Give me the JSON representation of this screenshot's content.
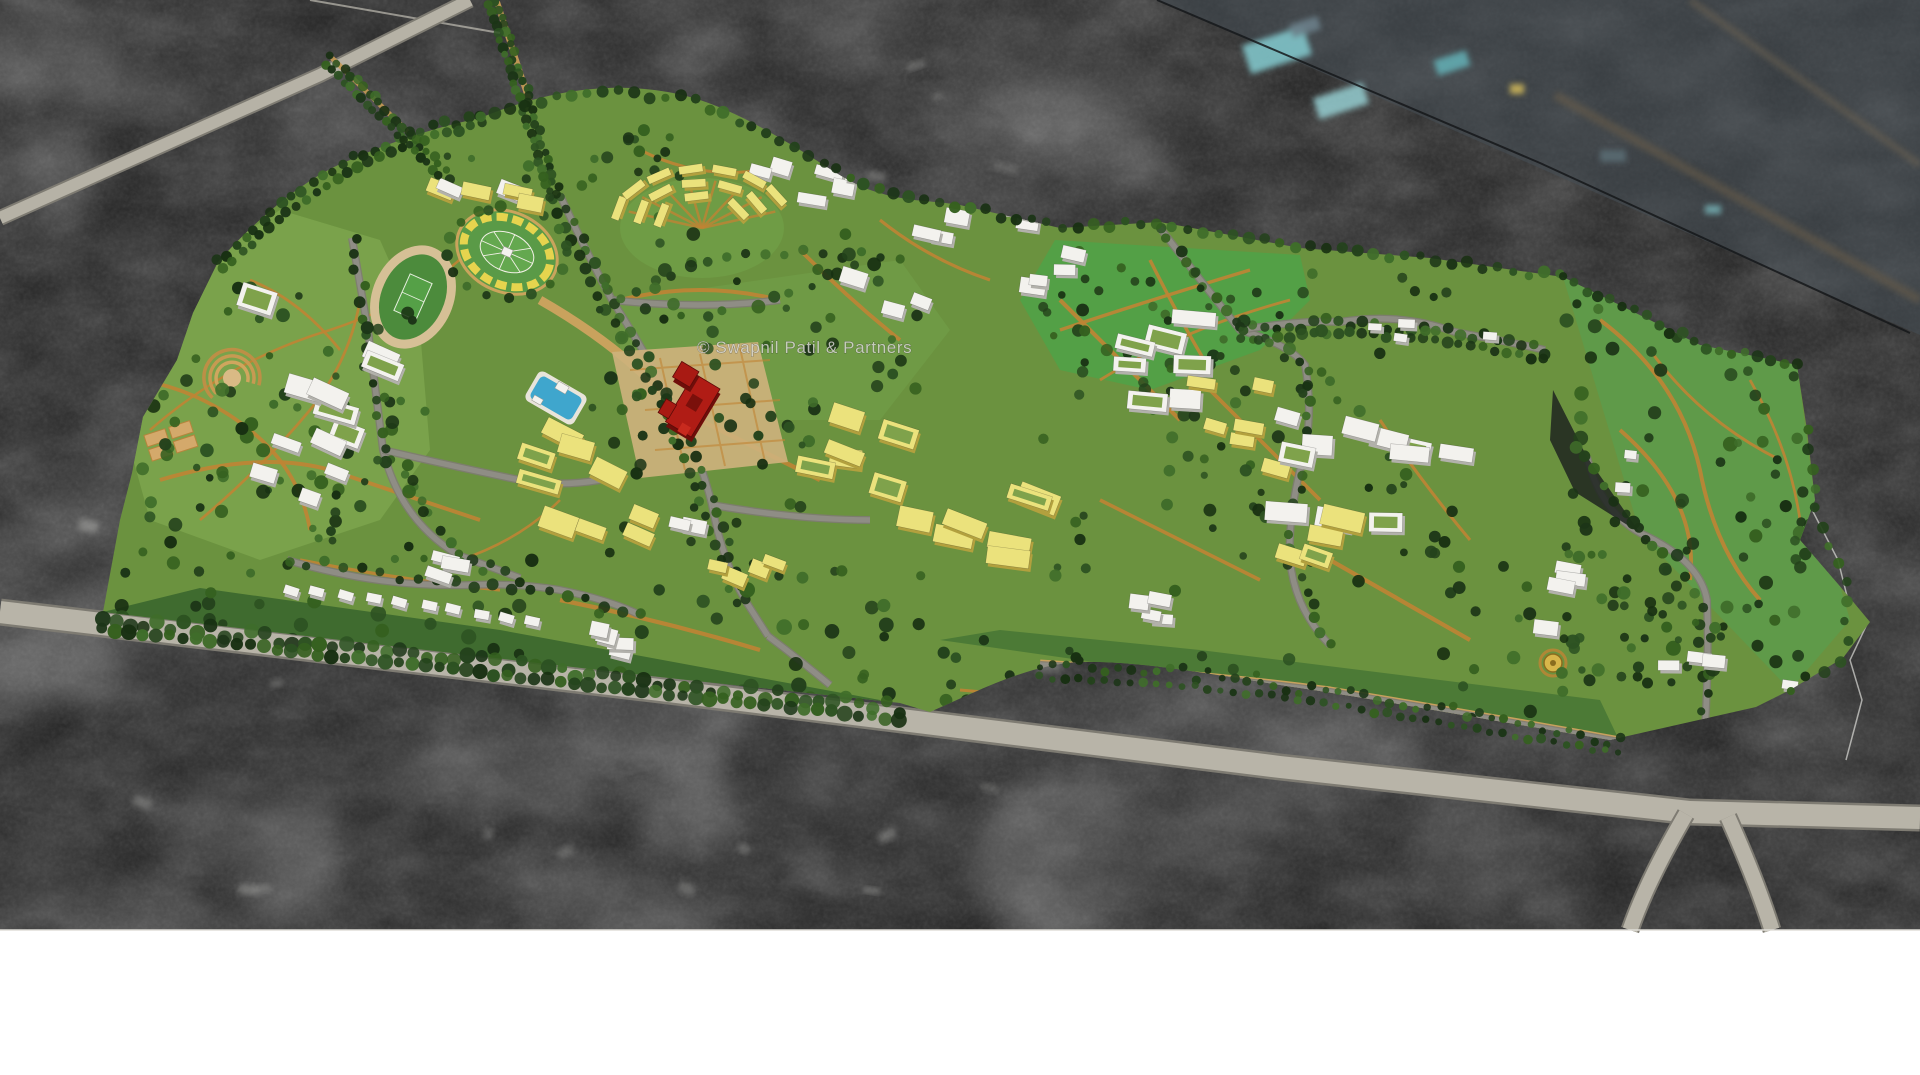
{
  "watermark": {
    "text": "© Swapnil Patil & Partners"
  },
  "scene": {
    "description": "aerial-masterplan-render-over-grayscale-satellite-photo",
    "features": [
      "satellite-basemap",
      "masterplan-site",
      "running-track",
      "oval-stadium-garden",
      "amphitheatre",
      "sports-courts",
      "swimming-pool",
      "red-landmark-building",
      "golden-plaza",
      "housing-crescent",
      "villa-row",
      "tree-lined-avenues",
      "perimeter-roads",
      "highway-junction",
      "forest-lobe",
      "city-zone-tinted"
    ]
  },
  "palette": {
    "page_bg": "#ffffff",
    "satellite_dark": "#242424",
    "satellite_mid": "#4a4a4a",
    "satellite_light": "#8f8f8f",
    "city_zone_tint": "#454e56",
    "city_roof_teal": "#84cbd0",
    "road_gray": "#b6b2a6",
    "road_edge": "#7e7b72",
    "inner_road": "#8f8d85",
    "site_green": "#6b923f",
    "park_green": "#7aa24b",
    "meadow_green": "#53a046",
    "forest_dark": "#24421c",
    "path_orange": "#c08434",
    "promenade_tan": "#cfa35f",
    "plaza_tan": "#d3b67c",
    "building_white": "#f3f2ee",
    "building_white_side": "#b2b1ab",
    "building_yellow": "#ebe27c",
    "building_yellow_side": "#b2a03e",
    "landmark_red": "#b01c15",
    "landmark_red_side": "#6f0e0a",
    "pool_blue": "#3fa6cd",
    "gold_accent": "#d8b64a",
    "track_tan": "#d6c096",
    "watermark_color": "#dcdcd6"
  }
}
